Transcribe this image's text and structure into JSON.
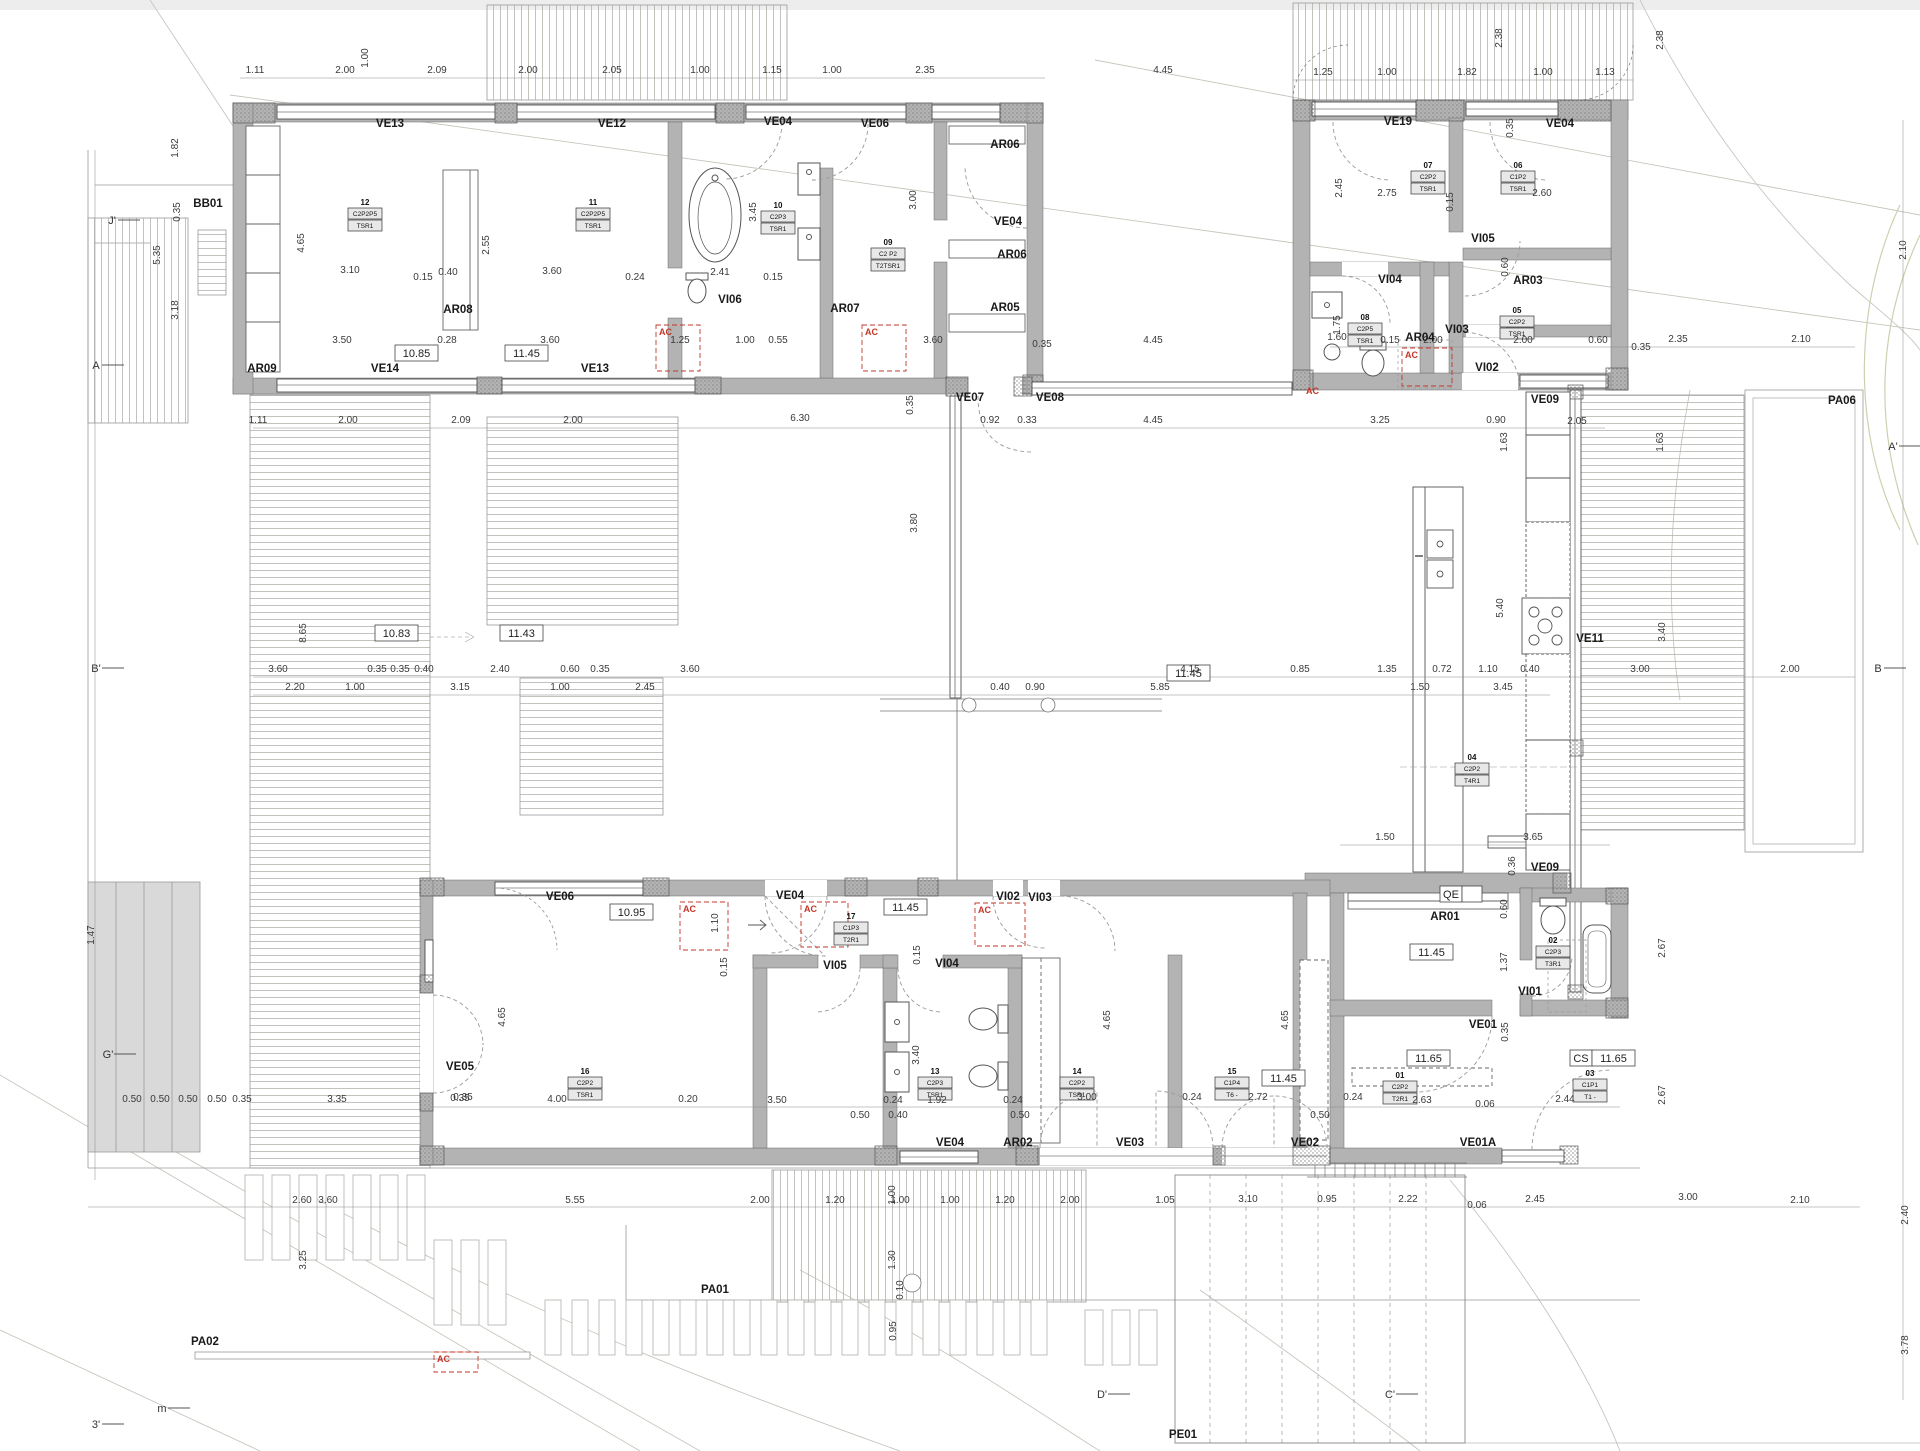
{
  "colors": {
    "wall": "#b3b3b3",
    "wall_edge": "#6b6b6b",
    "glazing_line": "#3c3c3c",
    "dim_text": "#3a3a3a",
    "red_ac": "#c43527",
    "deck_line": "#b4b4ae",
    "contour": "#c6c6bd"
  },
  "plan": {
    "ac_label": "AC",
    "codes": [
      [
        "BB01",
        208,
        207
      ],
      [
        "VE13",
        390,
        127
      ],
      [
        "VE12",
        612,
        127
      ],
      [
        "VE04",
        778,
        125
      ],
      [
        "VE06",
        875,
        127
      ],
      [
        "AR06",
        1005,
        148
      ],
      [
        "VE04",
        1008,
        225
      ],
      [
        "AR06",
        1012,
        258
      ],
      [
        "AR05",
        1005,
        311
      ],
      [
        "AR08",
        458,
        313
      ],
      [
        "AR09",
        262,
        372
      ],
      [
        "VE14",
        385,
        372
      ],
      [
        "VE13",
        595,
        372
      ],
      [
        "VI06",
        730,
        303
      ],
      [
        "AR07",
        845,
        312
      ],
      [
        "VE19",
        1398,
        125
      ],
      [
        "VE04",
        1560,
        127
      ],
      [
        "VI05",
        1483,
        242
      ],
      [
        "VI04",
        1390,
        283
      ],
      [
        "AR03",
        1528,
        284
      ],
      [
        "VI03",
        1457,
        333
      ],
      [
        "VI02",
        1487,
        371
      ],
      [
        "AR04",
        1420,
        341
      ],
      [
        "VE09",
        1545,
        403
      ],
      [
        "VE07",
        970,
        401
      ],
      [
        "VE08",
        1050,
        401
      ],
      [
        "VE11",
        1590,
        642
      ],
      [
        "PA06",
        1842,
        404
      ],
      [
        "VE06",
        560,
        900
      ],
      [
        "VE04",
        790,
        899
      ],
      [
        "VI05",
        835,
        969
      ],
      [
        "VE05",
        460,
        1070
      ],
      [
        "VI02",
        1008,
        900
      ],
      [
        "VI03",
        1040,
        901
      ],
      [
        "VI04",
        947,
        967
      ],
      [
        "VE04",
        950,
        1146
      ],
      [
        "AR02",
        1018,
        1146
      ],
      [
        "VE03",
        1130,
        1146
      ],
      [
        "VE02",
        1305,
        1146
      ],
      [
        "AR01",
        1445,
        920
      ],
      [
        "VI01",
        1530,
        995
      ],
      [
        "VE01",
        1483,
        1028
      ],
      [
        "VE01A",
        1478,
        1146
      ],
      [
        "VE09",
        1545,
        871
      ],
      [
        "PA01",
        715,
        1293
      ],
      [
        "PA02",
        205,
        1345
      ],
      [
        "PE01",
        1183,
        1438
      ]
    ],
    "boxed_values": [
      {
        "x": 395,
        "y": 357,
        "v": "10.85"
      },
      {
        "x": 505,
        "y": 357,
        "v": "11.45"
      },
      {
        "x": 375,
        "y": 637,
        "v": "10.83"
      },
      {
        "x": 500,
        "y": 637,
        "v": "11.43"
      },
      {
        "x": 610,
        "y": 916,
        "v": "10.95"
      },
      {
        "x": 884,
        "y": 911,
        "v": "11.45"
      },
      {
        "x": 1167,
        "y": 677,
        "v": "11.45"
      },
      {
        "x": 1262,
        "y": 1082,
        "v": "11.45"
      },
      {
        "x": 1410,
        "y": 956,
        "v": "11.45"
      },
      {
        "x": 1407,
        "y": 1062,
        "v": "11.65"
      },
      {
        "x": 1592,
        "y": 1062,
        "v": "11.65",
        "pre": "CS"
      },
      {
        "x": 1462,
        "y": 898,
        "v": "",
        "pre": "QE"
      }
    ],
    "room_tags": [
      {
        "x": 365,
        "y": 205,
        "no": "12",
        "l1": "C2P2P5",
        "l2": "TSR1"
      },
      {
        "x": 593,
        "y": 205,
        "no": "11",
        "l1": "C2P2P5",
        "l2": "TSR1"
      },
      {
        "x": 778,
        "y": 208,
        "no": "10",
        "l1": "C2P3",
        "l2": "TSR1"
      },
      {
        "x": 888,
        "y": 245,
        "no": "09",
        "l1": "C2 P2",
        "l2": "T2TSR1"
      },
      {
        "x": 1428,
        "y": 168,
        "no": "07",
        "l1": "C2P2",
        "l2": "TSR1"
      },
      {
        "x": 1518,
        "y": 168,
        "no": "06",
        "l1": "C1P2",
        "l2": "TSR1"
      },
      {
        "x": 1365,
        "y": 320,
        "no": "08",
        "l1": "C2P5",
        "l2": "TSR1"
      },
      {
        "x": 1517,
        "y": 313,
        "no": "05",
        "l1": "C2P2",
        "l2": "TSR1"
      },
      {
        "x": 1472,
        "y": 760,
        "no": "04",
        "l1": "C2P2",
        "l2": "T4R1"
      },
      {
        "x": 585,
        "y": 1074,
        "no": "16",
        "l1": "C2P2",
        "l2": "TSR1"
      },
      {
        "x": 851,
        "y": 919,
        "no": "17",
        "l1": "C1P3",
        "l2": "T2R1"
      },
      {
        "x": 935,
        "y": 1074,
        "no": "13",
        "l1": "C2P3",
        "l2": "TSR1"
      },
      {
        "x": 1077,
        "y": 1074,
        "no": "14",
        "l1": "C2P2",
        "l2": "TSR1"
      },
      {
        "x": 1232,
        "y": 1074,
        "no": "15",
        "l1": "C1P4",
        "l2": "T6 -"
      },
      {
        "x": 1553,
        "y": 943,
        "no": "02",
        "l1": "C2P3",
        "l2": "T3R1"
      },
      {
        "x": 1400,
        "y": 1078,
        "no": "01",
        "l1": "C2P2",
        "l2": "T2R1"
      },
      {
        "x": 1590,
        "y": 1076,
        "no": "03",
        "l1": "C1P1",
        "l2": "T1 -"
      }
    ],
    "ac_boxes": [
      [
        656,
        325,
        44,
        46
      ],
      [
        862,
        325,
        44,
        46
      ],
      [
        1402,
        348,
        50,
        38
      ],
      [
        680,
        902,
        48,
        48
      ],
      [
        801,
        902,
        47,
        45
      ],
      [
        975,
        903,
        50,
        43
      ],
      [
        434,
        1352,
        44,
        20
      ]
    ],
    "ac_texts": [
      [
        1306,
        394
      ]
    ],
    "markers": [
      [
        "J'",
        112,
        224
      ],
      [
        "A",
        96,
        369
      ],
      [
        "B'",
        96,
        672
      ],
      [
        "G'",
        108,
        1058
      ],
      [
        "3'",
        96,
        1428
      ],
      [
        "m",
        162,
        1412
      ],
      [
        "D'",
        1102,
        1398
      ],
      [
        "C'",
        1390,
        1398
      ],
      [
        "A'",
        1893,
        450
      ],
      [
        "B",
        1878,
        672
      ]
    ],
    "dims": [
      [
        255,
        73,
        "1.11"
      ],
      [
        345,
        73,
        "2.00"
      ],
      [
        437,
        73,
        "2.09"
      ],
      [
        528,
        73,
        "2.00"
      ],
      [
        612,
        73,
        "2.05"
      ],
      [
        700,
        73,
        "1.00"
      ],
      [
        772,
        73,
        "1.15"
      ],
      [
        832,
        73,
        "1.00"
      ],
      [
        925,
        73,
        "2.35"
      ],
      [
        1163,
        73,
        "4.45"
      ],
      [
        1323,
        75,
        "1.25"
      ],
      [
        1387,
        75,
        "1.00"
      ],
      [
        1467,
        75,
        "1.82"
      ],
      [
        1543,
        75,
        "1.00"
      ],
      [
        1605,
        75,
        "1.13"
      ],
      [
        1502,
        38,
        "2.38",
        1
      ],
      [
        1663,
        40,
        "2.38",
        1
      ],
      [
        368,
        58,
        "1.00",
        1
      ],
      [
        178,
        148,
        "1.82",
        1
      ],
      [
        180,
        212,
        "0.35",
        1
      ],
      [
        160,
        255,
        "5.35",
        1
      ],
      [
        178,
        310,
        "3.18",
        1
      ],
      [
        304,
        243,
        "4.65",
        1
      ],
      [
        489,
        245,
        "2.55",
        1
      ],
      [
        756,
        212,
        "3.45",
        1
      ],
      [
        916,
        200,
        "3.00",
        1
      ],
      [
        1513,
        128,
        "0.35",
        1
      ],
      [
        1342,
        188,
        "2.45",
        1
      ],
      [
        1453,
        202,
        "0.15",
        1
      ],
      [
        1508,
        267,
        "0.60",
        1
      ],
      [
        1340,
        325,
        "1.75",
        1
      ],
      [
        350,
        273,
        "3.10"
      ],
      [
        448,
        275,
        "0.40"
      ],
      [
        552,
        274,
        "3.60"
      ],
      [
        635,
        280,
        "0.24"
      ],
      [
        720,
        275,
        "2.41"
      ],
      [
        773,
        280,
        "0.15"
      ],
      [
        423,
        280,
        "0.15"
      ],
      [
        1387,
        196,
        "2.75"
      ],
      [
        1542,
        196,
        "2.60"
      ],
      [
        342,
        343,
        "3.50"
      ],
      [
        447,
        343,
        "0.28"
      ],
      [
        550,
        343,
        "3.60"
      ],
      [
        680,
        343,
        "1.25"
      ],
      [
        745,
        343,
        "1.00"
      ],
      [
        778,
        343,
        "0.55"
      ],
      [
        933,
        343,
        "3.60"
      ],
      [
        1042,
        347,
        "0.35"
      ],
      [
        1153,
        343,
        "4.45"
      ],
      [
        1337,
        340,
        "1.60"
      ],
      [
        1390,
        343,
        "0.15"
      ],
      [
        1433,
        343,
        "2.00"
      ],
      [
        1523,
        343,
        "2.00"
      ],
      [
        1598,
        343,
        "0.60"
      ],
      [
        1641,
        350,
        "0.35"
      ],
      [
        1678,
        342,
        "2.35"
      ],
      [
        1801,
        342,
        "2.10"
      ],
      [
        258,
        423,
        "1.11"
      ],
      [
        348,
        423,
        "2.00"
      ],
      [
        461,
        423,
        "2.09"
      ],
      [
        573,
        423,
        "2.00"
      ],
      [
        800,
        421,
        "6.30"
      ],
      [
        990,
        423,
        "0.92"
      ],
      [
        1027,
        423,
        "0.33"
      ],
      [
        1153,
        423,
        "4.45"
      ],
      [
        1380,
        423,
        "3.25"
      ],
      [
        1496,
        423,
        "0.90"
      ],
      [
        1577,
        424,
        "2.05"
      ],
      [
        306,
        633,
        "8.65",
        1
      ],
      [
        917,
        523,
        "3.80",
        1
      ],
      [
        913,
        405,
        "0.35",
        1
      ],
      [
        1507,
        442,
        "1.63",
        1
      ],
      [
        1663,
        442,
        "1.63",
        1
      ],
      [
        1503,
        608,
        "5.40",
        1
      ],
      [
        1665,
        632,
        "3.40",
        1
      ],
      [
        278,
        672,
        "3.60"
      ],
      [
        377,
        672,
        "0.35"
      ],
      [
        400,
        672,
        "0.35"
      ],
      [
        424,
        672,
        "0.40"
      ],
      [
        500,
        672,
        "2.40"
      ],
      [
        570,
        672,
        "0.60"
      ],
      [
        600,
        672,
        "0.35"
      ],
      [
        690,
        672,
        "3.60"
      ],
      [
        1190,
        672,
        "4.15"
      ],
      [
        1300,
        672,
        "0.85"
      ],
      [
        1387,
        672,
        "1.35"
      ],
      [
        1442,
        672,
        "0.72"
      ],
      [
        1488,
        672,
        "1.10"
      ],
      [
        1530,
        672,
        "0.40"
      ],
      [
        1640,
        672,
        "3.00"
      ],
      [
        1790,
        672,
        "2.00"
      ],
      [
        295,
        690,
        "2.20"
      ],
      [
        355,
        690,
        "1.00"
      ],
      [
        460,
        690,
        "3.15"
      ],
      [
        560,
        690,
        "1.00"
      ],
      [
        645,
        690,
        "2.45"
      ],
      [
        1000,
        690,
        "0.40"
      ],
      [
        1035,
        690,
        "0.90"
      ],
      [
        1160,
        690,
        "5.85"
      ],
      [
        1420,
        690,
        "1.50"
      ],
      [
        1503,
        690,
        "3.45"
      ],
      [
        1385,
        840,
        "1.50"
      ],
      [
        1533,
        840,
        "3.65"
      ],
      [
        463,
        1100,
        "0.35"
      ],
      [
        557,
        1102,
        "4.00"
      ],
      [
        688,
        1102,
        "0.20"
      ],
      [
        777,
        1103,
        "3.50"
      ],
      [
        893,
        1103,
        "0.24"
      ],
      [
        937,
        1103,
        "1.92"
      ],
      [
        1013,
        1103,
        "0.24"
      ],
      [
        1087,
        1100,
        "3.00"
      ],
      [
        1192,
        1100,
        "0.24"
      ],
      [
        1258,
        1100,
        "2.72"
      ],
      [
        1353,
        1100,
        "0.24"
      ],
      [
        1422,
        1103,
        "2.63"
      ],
      [
        1485,
        1107,
        "0.06"
      ],
      [
        1565,
        1102,
        "2.44"
      ],
      [
        860,
        1118,
        "0.50"
      ],
      [
        898,
        1118,
        "0.40"
      ],
      [
        1020,
        1118,
        "0.50"
      ],
      [
        1320,
        1118,
        "0.50"
      ],
      [
        505,
        1017,
        "4.65",
        1
      ],
      [
        727,
        967,
        "0.15",
        1
      ],
      [
        919,
        1055,
        "3.40",
        1
      ],
      [
        1110,
        1020,
        "4.65",
        1
      ],
      [
        1288,
        1020,
        "4.65",
        1
      ],
      [
        718,
        923,
        "1.10",
        1
      ],
      [
        920,
        955,
        "0.15",
        1
      ],
      [
        1507,
        909,
        "0.60",
        1
      ],
      [
        1507,
        962,
        "1.37",
        1
      ],
      [
        1508,
        1032,
        "0.35",
        1
      ],
      [
        1665,
        948,
        "2.67",
        1
      ],
      [
        1665,
        1095,
        "2.67",
        1
      ],
      [
        1515,
        866,
        "0.36",
        1
      ],
      [
        302,
        1203,
        "2.60"
      ],
      [
        575,
        1203,
        "5.55"
      ],
      [
        760,
        1203,
        "2.00"
      ],
      [
        835,
        1203,
        "1.20"
      ],
      [
        900,
        1203,
        "1.00"
      ],
      [
        950,
        1203,
        "1.00"
      ],
      [
        1005,
        1203,
        "1.20"
      ],
      [
        1070,
        1203,
        "2.00"
      ],
      [
        1165,
        1203,
        "1.05"
      ],
      [
        1248,
        1202,
        "3.10"
      ],
      [
        1327,
        1202,
        "0.95"
      ],
      [
        1408,
        1202,
        "2.22"
      ],
      [
        1477,
        1208,
        "0.06"
      ],
      [
        1535,
        1202,
        "2.45"
      ],
      [
        1688,
        1200,
        "3.00"
      ],
      [
        1800,
        1203,
        "2.10"
      ],
      [
        895,
        1195,
        "1.00",
        1
      ],
      [
        895,
        1260,
        "1.30",
        1
      ],
      [
        903,
        1290,
        "0.10",
        1
      ],
      [
        896,
        1331,
        "0.95",
        1
      ],
      [
        306,
        1260,
        "3.25",
        1
      ],
      [
        328,
        1203,
        "3.60"
      ],
      [
        132,
        1102,
        "0.50"
      ],
      [
        160,
        1102,
        "0.50"
      ],
      [
        188,
        1102,
        "0.50"
      ],
      [
        217,
        1102,
        "0.50"
      ],
      [
        242,
        1102,
        "0.35"
      ],
      [
        337,
        1102,
        "3.35"
      ],
      [
        460,
        1101,
        "0.35"
      ],
      [
        94,
        935,
        "1.47",
        1
      ],
      [
        1906,
        250,
        "2.10",
        1
      ],
      [
        1908,
        1215,
        "2.40",
        1
      ],
      [
        1908,
        1345,
        "3.78",
        1
      ]
    ]
  }
}
